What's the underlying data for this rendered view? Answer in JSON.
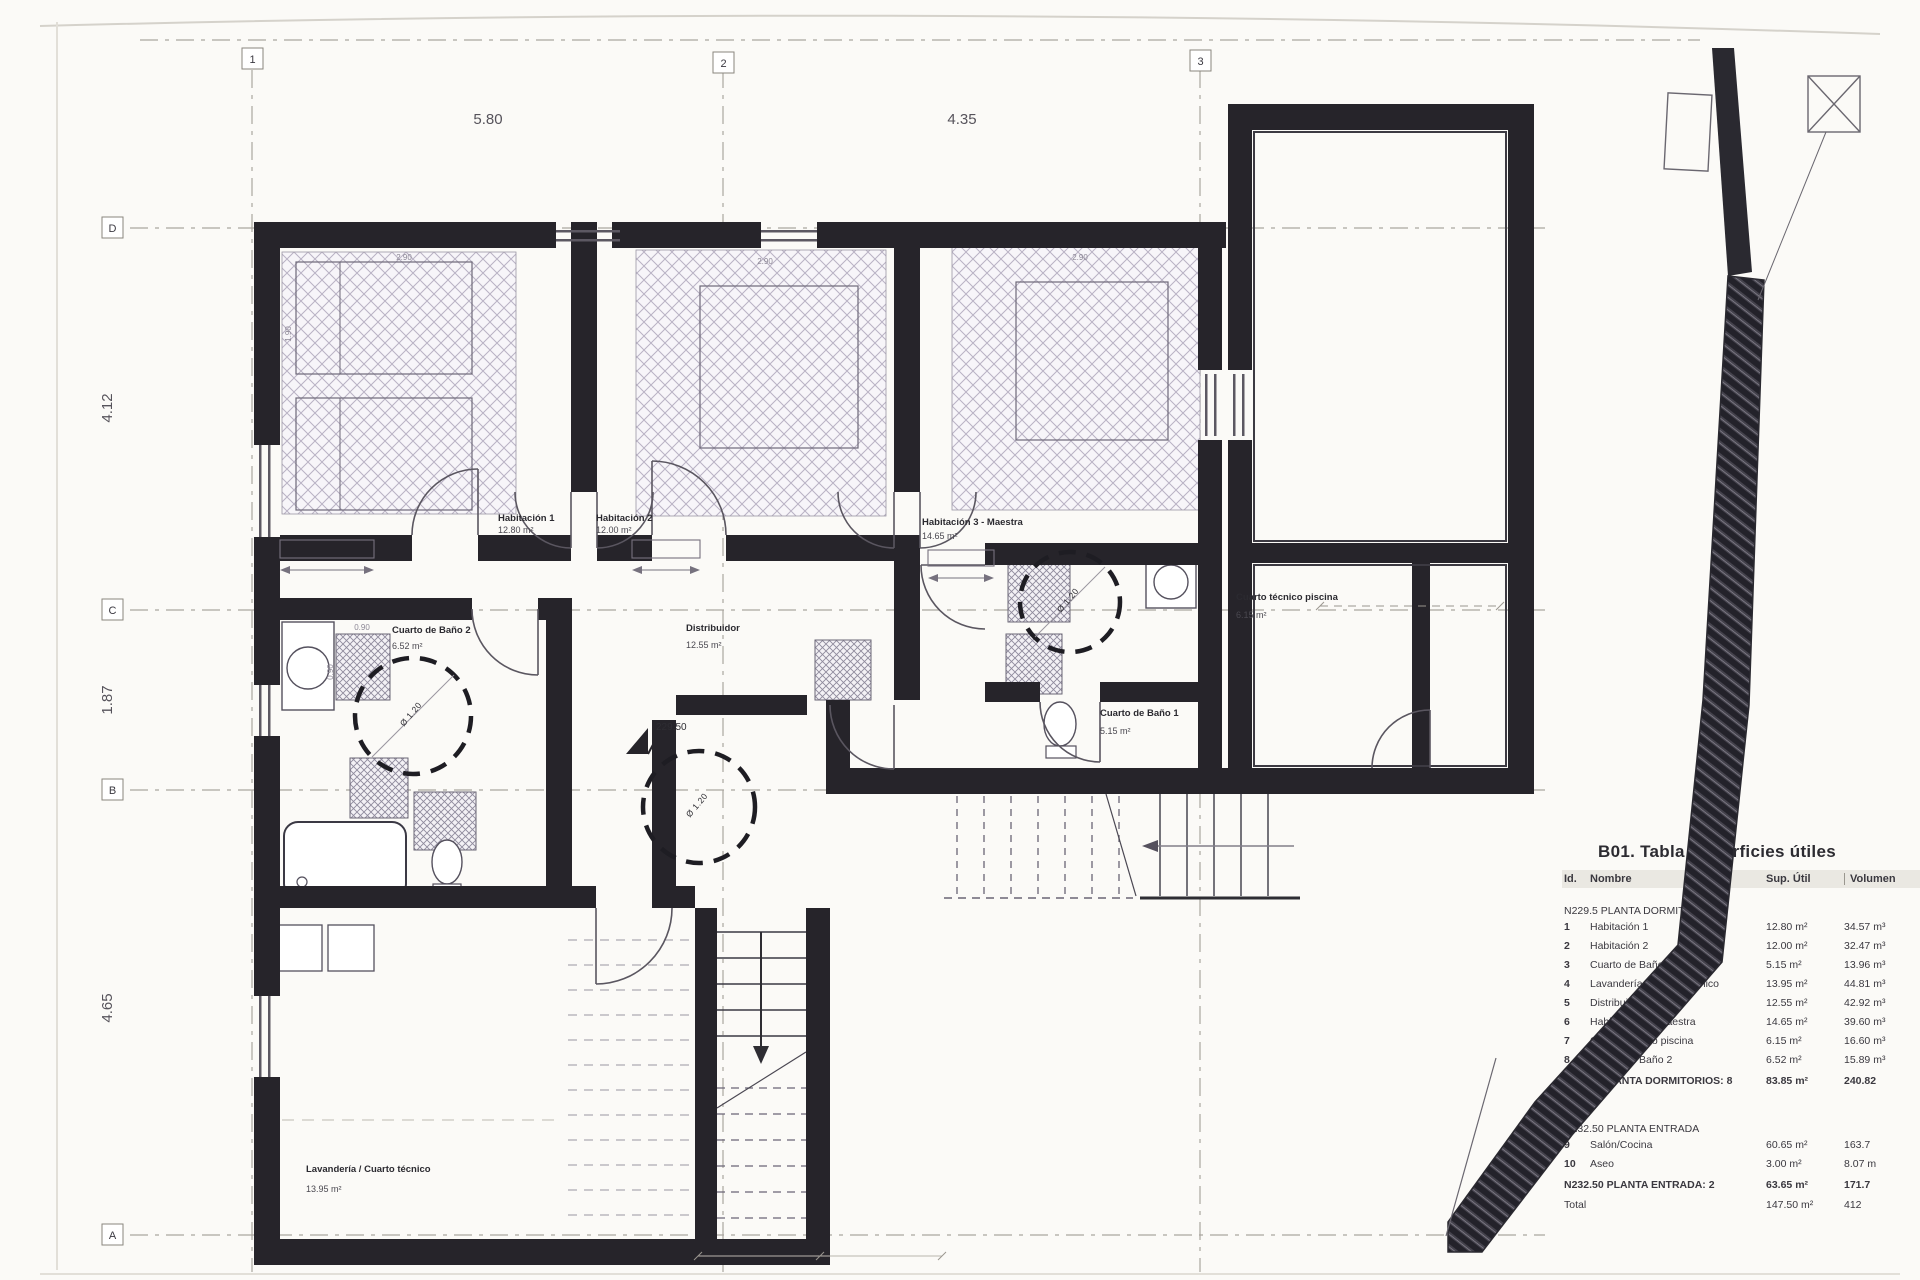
{
  "grid": {
    "cols": [
      "1",
      "2",
      "3"
    ],
    "rows": [
      "D",
      "C",
      "B",
      "A"
    ],
    "top_dims": [
      "5.80",
      "4.35"
    ],
    "left_dims": [
      "4.12",
      "1.87",
      "4.65"
    ]
  },
  "levels": {
    "plan_level": "229.50"
  },
  "annotations": {
    "turn_circle": "Ø 1.20",
    "bed_dim_w": "2.90",
    "bed_dim_h": "1.90",
    "fix_dim": "0.90"
  },
  "rooms": [
    {
      "name": "Habitación 1",
      "area": "12.80 m²"
    },
    {
      "name": "Habitación 2",
      "area": "12.00 m²"
    },
    {
      "name": "Habitación 3 - Maestra",
      "area": "14.65 m²"
    },
    {
      "name": "Cuarto de Baño 2",
      "area": "6.52 m²"
    },
    {
      "name": "Distribuidor",
      "area": "12.55 m²"
    },
    {
      "name": "Cuarto de Baño 1",
      "area": "5.15 m²"
    },
    {
      "name": "Cuarto técnico piscina",
      "area": "6.15 m²"
    },
    {
      "name": "Lavandería / Cuarto técnico",
      "area": "13.95 m²"
    }
  ],
  "table": {
    "title": "B01. Tabla Superficies útiles",
    "headers": {
      "id": "Id.",
      "nombre": "Nombre",
      "sup": "Sup. Útil",
      "vol": "Volumen"
    },
    "section1": {
      "label": "N229.5 PLANTA DORMITORIOS:",
      "rows": [
        {
          "id": "1",
          "nombre": "Habitación 1",
          "sup": "12.80 m²",
          "vol": "34.57 m³"
        },
        {
          "id": "2",
          "nombre": "Habitación 2",
          "sup": "12.00 m²",
          "vol": "32.47 m³"
        },
        {
          "id": "3",
          "nombre": "Cuarto de Baño 1",
          "sup": "5.15 m²",
          "vol": "13.96 m³"
        },
        {
          "id": "4",
          "nombre": "Lavandería / Cuarto técnico",
          "sup": "13.95 m²",
          "vol": "44.81 m³"
        },
        {
          "id": "5",
          "nombre": "Distribuidor",
          "sup": "12.55 m²",
          "vol": "42.92 m³"
        },
        {
          "id": "6",
          "nombre": "Habitación 3 - Maestra",
          "sup": "14.65 m²",
          "vol": "39.60 m³"
        },
        {
          "id": "7",
          "nombre": "Cuarto técnico piscina",
          "sup": "6.15 m²",
          "vol": "16.60 m³"
        },
        {
          "id": "8",
          "nombre": "Cuarto de Baño 2",
          "sup": "6.52 m²",
          "vol": "15.89 m³"
        }
      ],
      "subtotal": {
        "label": "N229.5 PLANTA DORMITORIOS: 8",
        "sup": "83.85 m²",
        "vol": "240.82"
      }
    },
    "section2": {
      "label": "N232.50 PLANTA ENTRADA",
      "rows": [
        {
          "id": "9",
          "nombre": "Salón/Cocina",
          "sup": "60.65 m²",
          "vol": "163.7"
        },
        {
          "id": "10",
          "nombre": "Aseo",
          "sup": "3.00 m²",
          "vol": "8.07 m"
        }
      ],
      "subtotal": {
        "label": "N232.50 PLANTA ENTRADA: 2",
        "sup": "63.65 m²",
        "vol": "171.7"
      }
    },
    "total": {
      "label": "Total",
      "sup": "147.50 m²",
      "vol": "412"
    }
  }
}
